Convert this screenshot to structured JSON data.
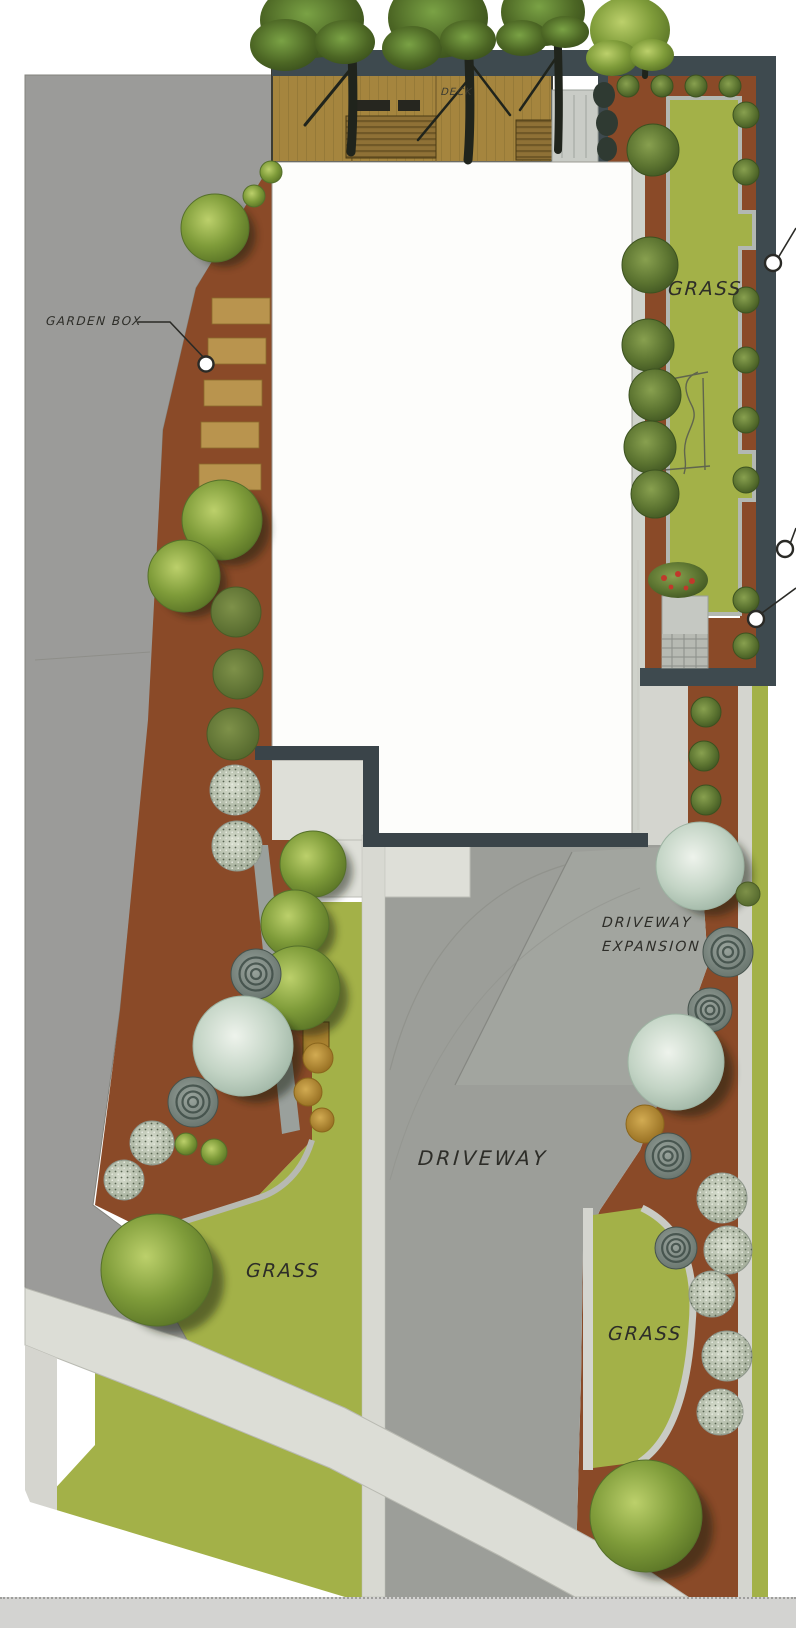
{
  "plan": {
    "labels": {
      "garden_box": "GARDEN BOX",
      "deck": "DECK",
      "grass_backyard": "GRASS",
      "driveway_expansion_line1": "DRIVEWAY",
      "driveway_expansion_line2": "EXPANSION",
      "driveway": "DRIVEWAY",
      "grass_front_left": "GRASS",
      "grass_front_right": "GRASS"
    },
    "callout_markers": [
      "garden-box",
      "right-upper",
      "right-middle",
      "right-lower"
    ],
    "colors": {
      "mulch": "#8A4A28",
      "lawn": "#A3B148",
      "driveway_paving": "#9C9E99",
      "sidewalk": "#DCDDD6",
      "street_pavement": "#9B9B99",
      "deck_wood": "#A5853E",
      "garden_box_wood": "#B9944E",
      "fence": "#3E4A4F",
      "house_footprint": "#FFFFFF",
      "tree_canopy": "#7F9C3A",
      "silver_tree": "#C2D3C3",
      "bottom_bar": "#D3D3D1"
    }
  }
}
